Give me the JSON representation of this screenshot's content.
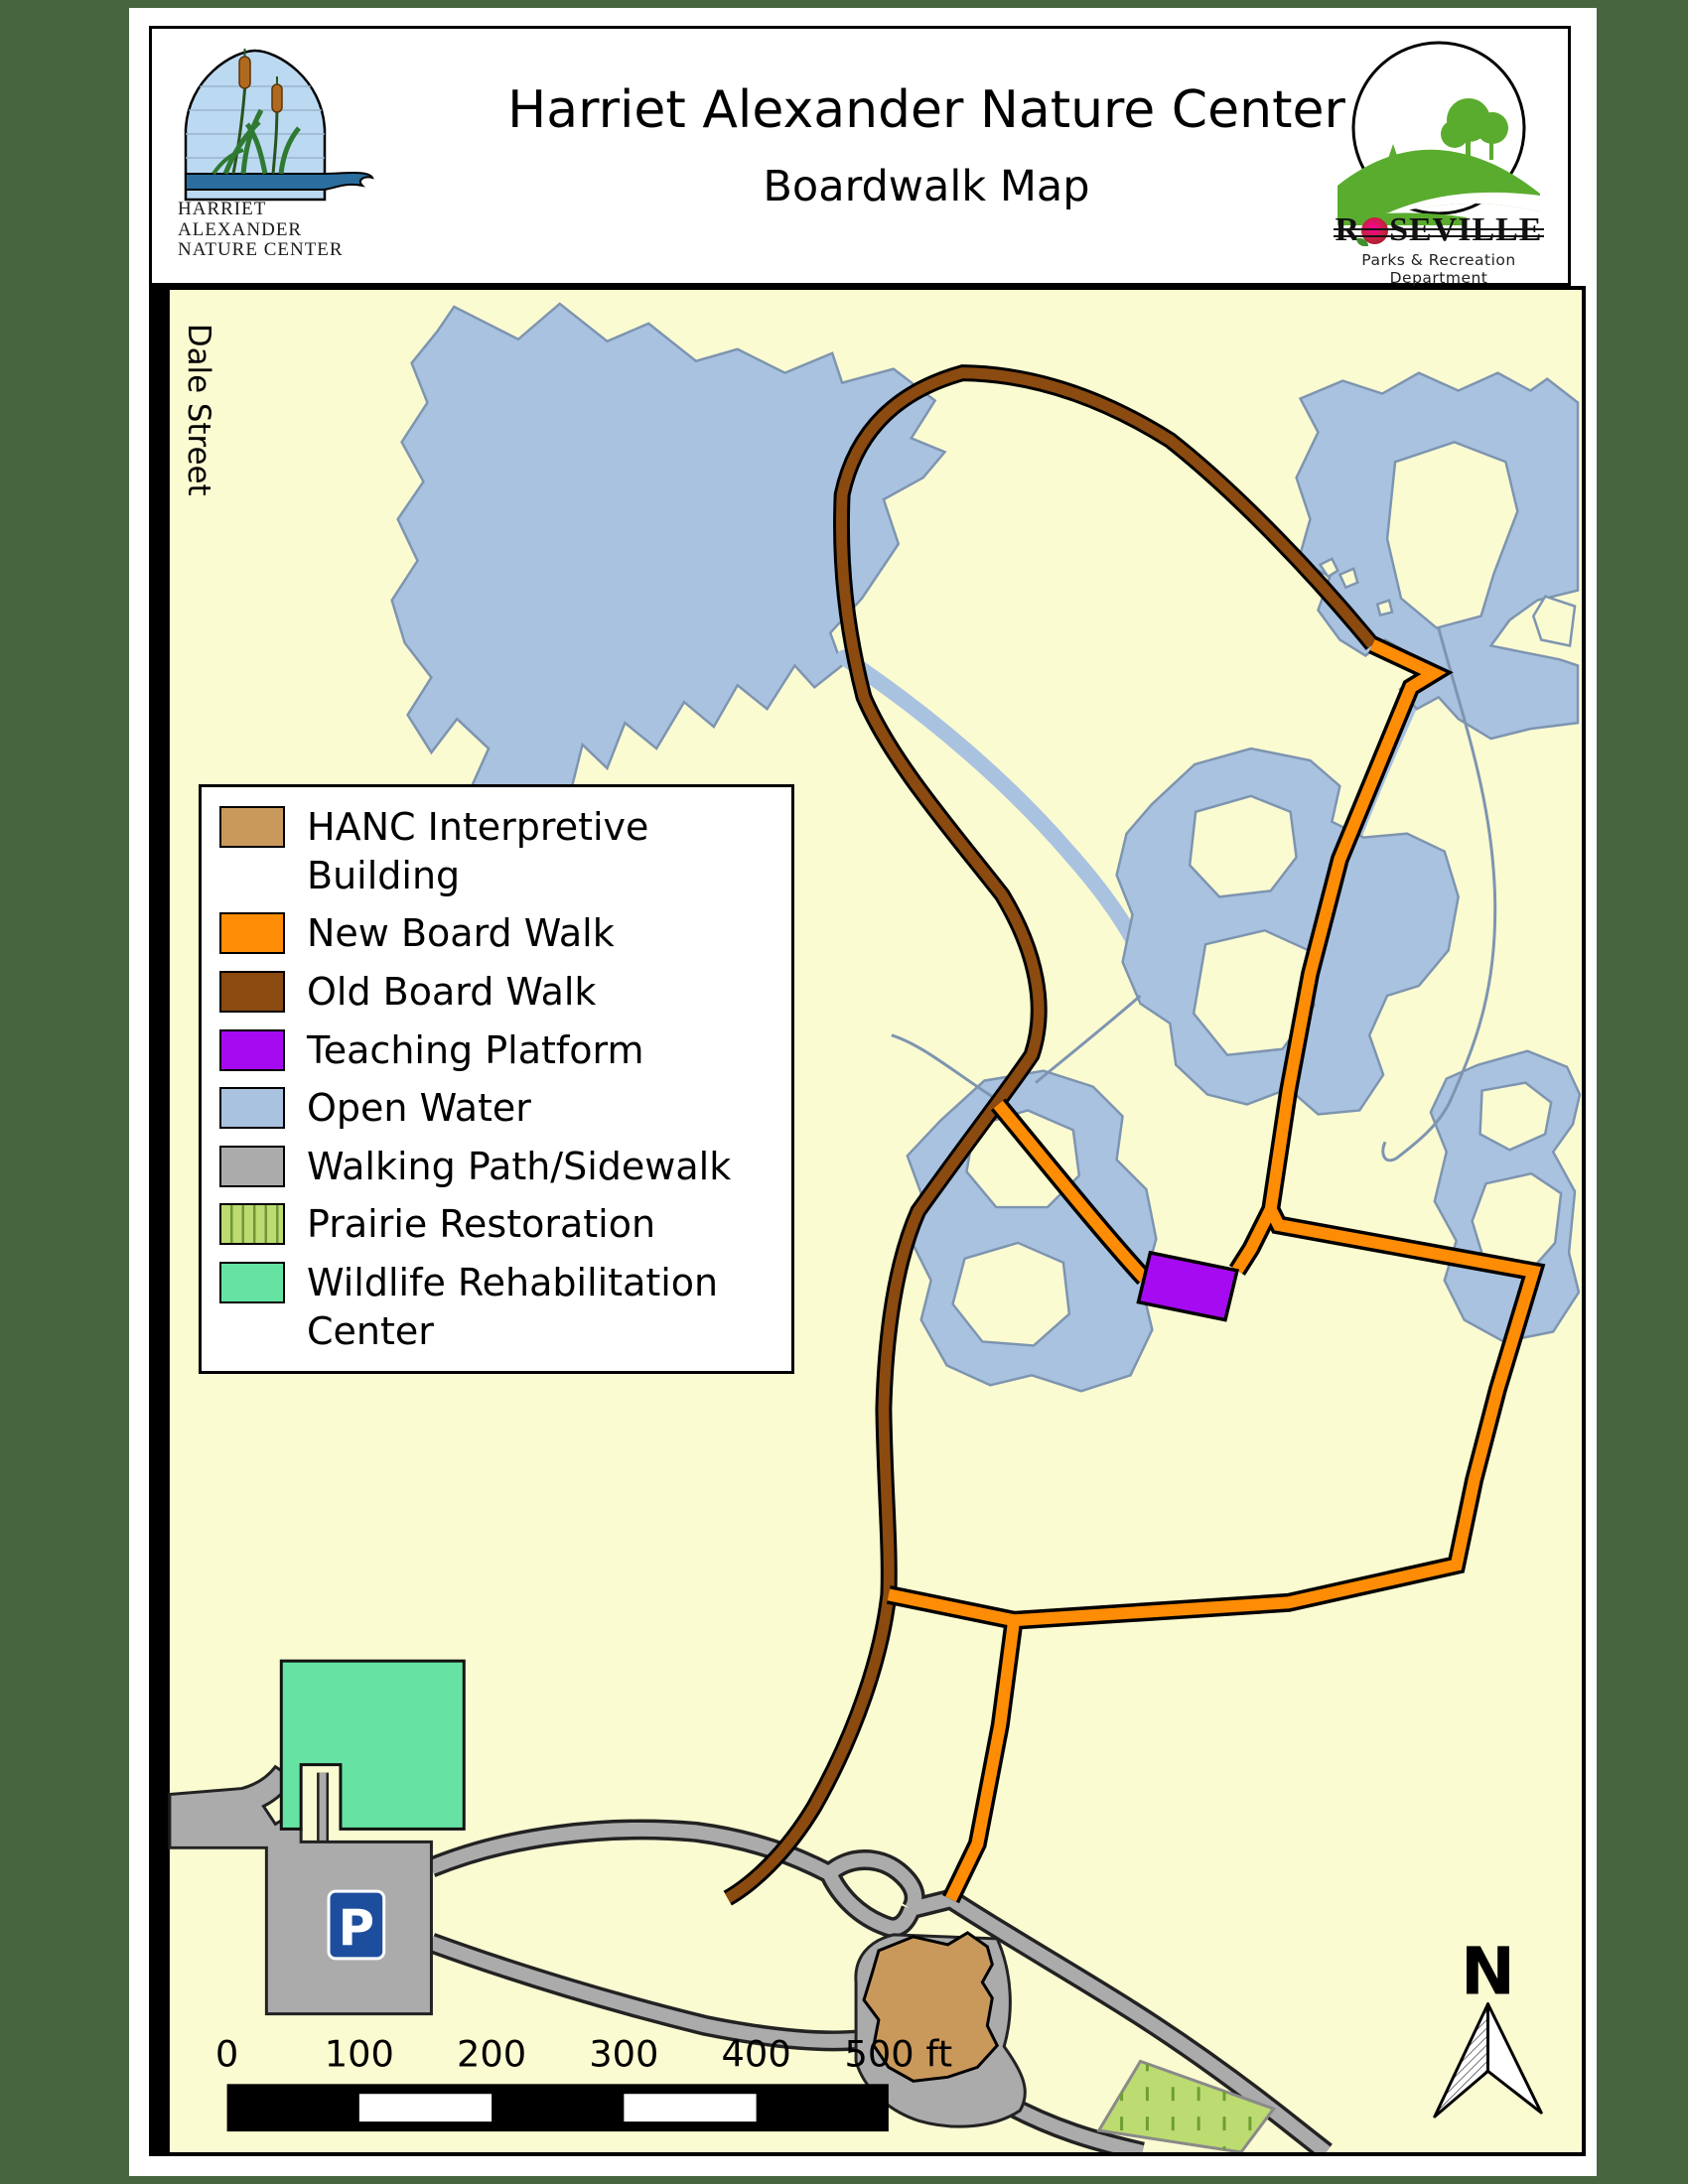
{
  "header": {
    "title": "Harriet Alexander Nature Center",
    "subtitle": "Boardwalk Map",
    "left_logo_text": "HARRIET\nALEXANDER\nNATURE CENTER",
    "right_logo": {
      "name_r": "R",
      "name_rest": "SEVILLE",
      "tagline": "Parks & Recreation  Department"
    }
  },
  "map": {
    "street_label": "Dale Street",
    "parking_label": "P",
    "north_label": "N"
  },
  "scalebar": {
    "ticks": [
      "0",
      "100",
      "200",
      "300",
      "400",
      "500 ft"
    ]
  },
  "legend": {
    "items": [
      {
        "label": "HANC Interpretive\nBuilding",
        "color": "#c9995c"
      },
      {
        "label": "New Board Walk",
        "color": "#ff8c05"
      },
      {
        "label": "Old Board Walk",
        "color": "#8a4a10"
      },
      {
        "label": "Teaching Platform",
        "color": "#a50af0"
      },
      {
        "label": "Open Water",
        "color": "#a9c2e0"
      },
      {
        "label": "Walking Path/Sidewalk",
        "color": "#ababab"
      },
      {
        "label": "Prairie Restoration",
        "color": "#bcdb70"
      },
      {
        "label": "Wildlife Rehabilitation\nCenter",
        "color": "#66e3a3"
      }
    ]
  },
  "colors": {
    "page_green": "#47663f",
    "map_bg": "#fbfbd2",
    "water": "#a9c2e0",
    "new_boardwalk": "#ff8c05",
    "old_boardwalk": "#8a4a10",
    "teaching_platform": "#a50af0",
    "walking_path": "#ababab",
    "prairie": "#bcdb70",
    "wildlife": "#66e3a3",
    "building_tan": "#c9995c",
    "parking_sign": "#1d4e9e",
    "street_bar": "#000000"
  }
}
